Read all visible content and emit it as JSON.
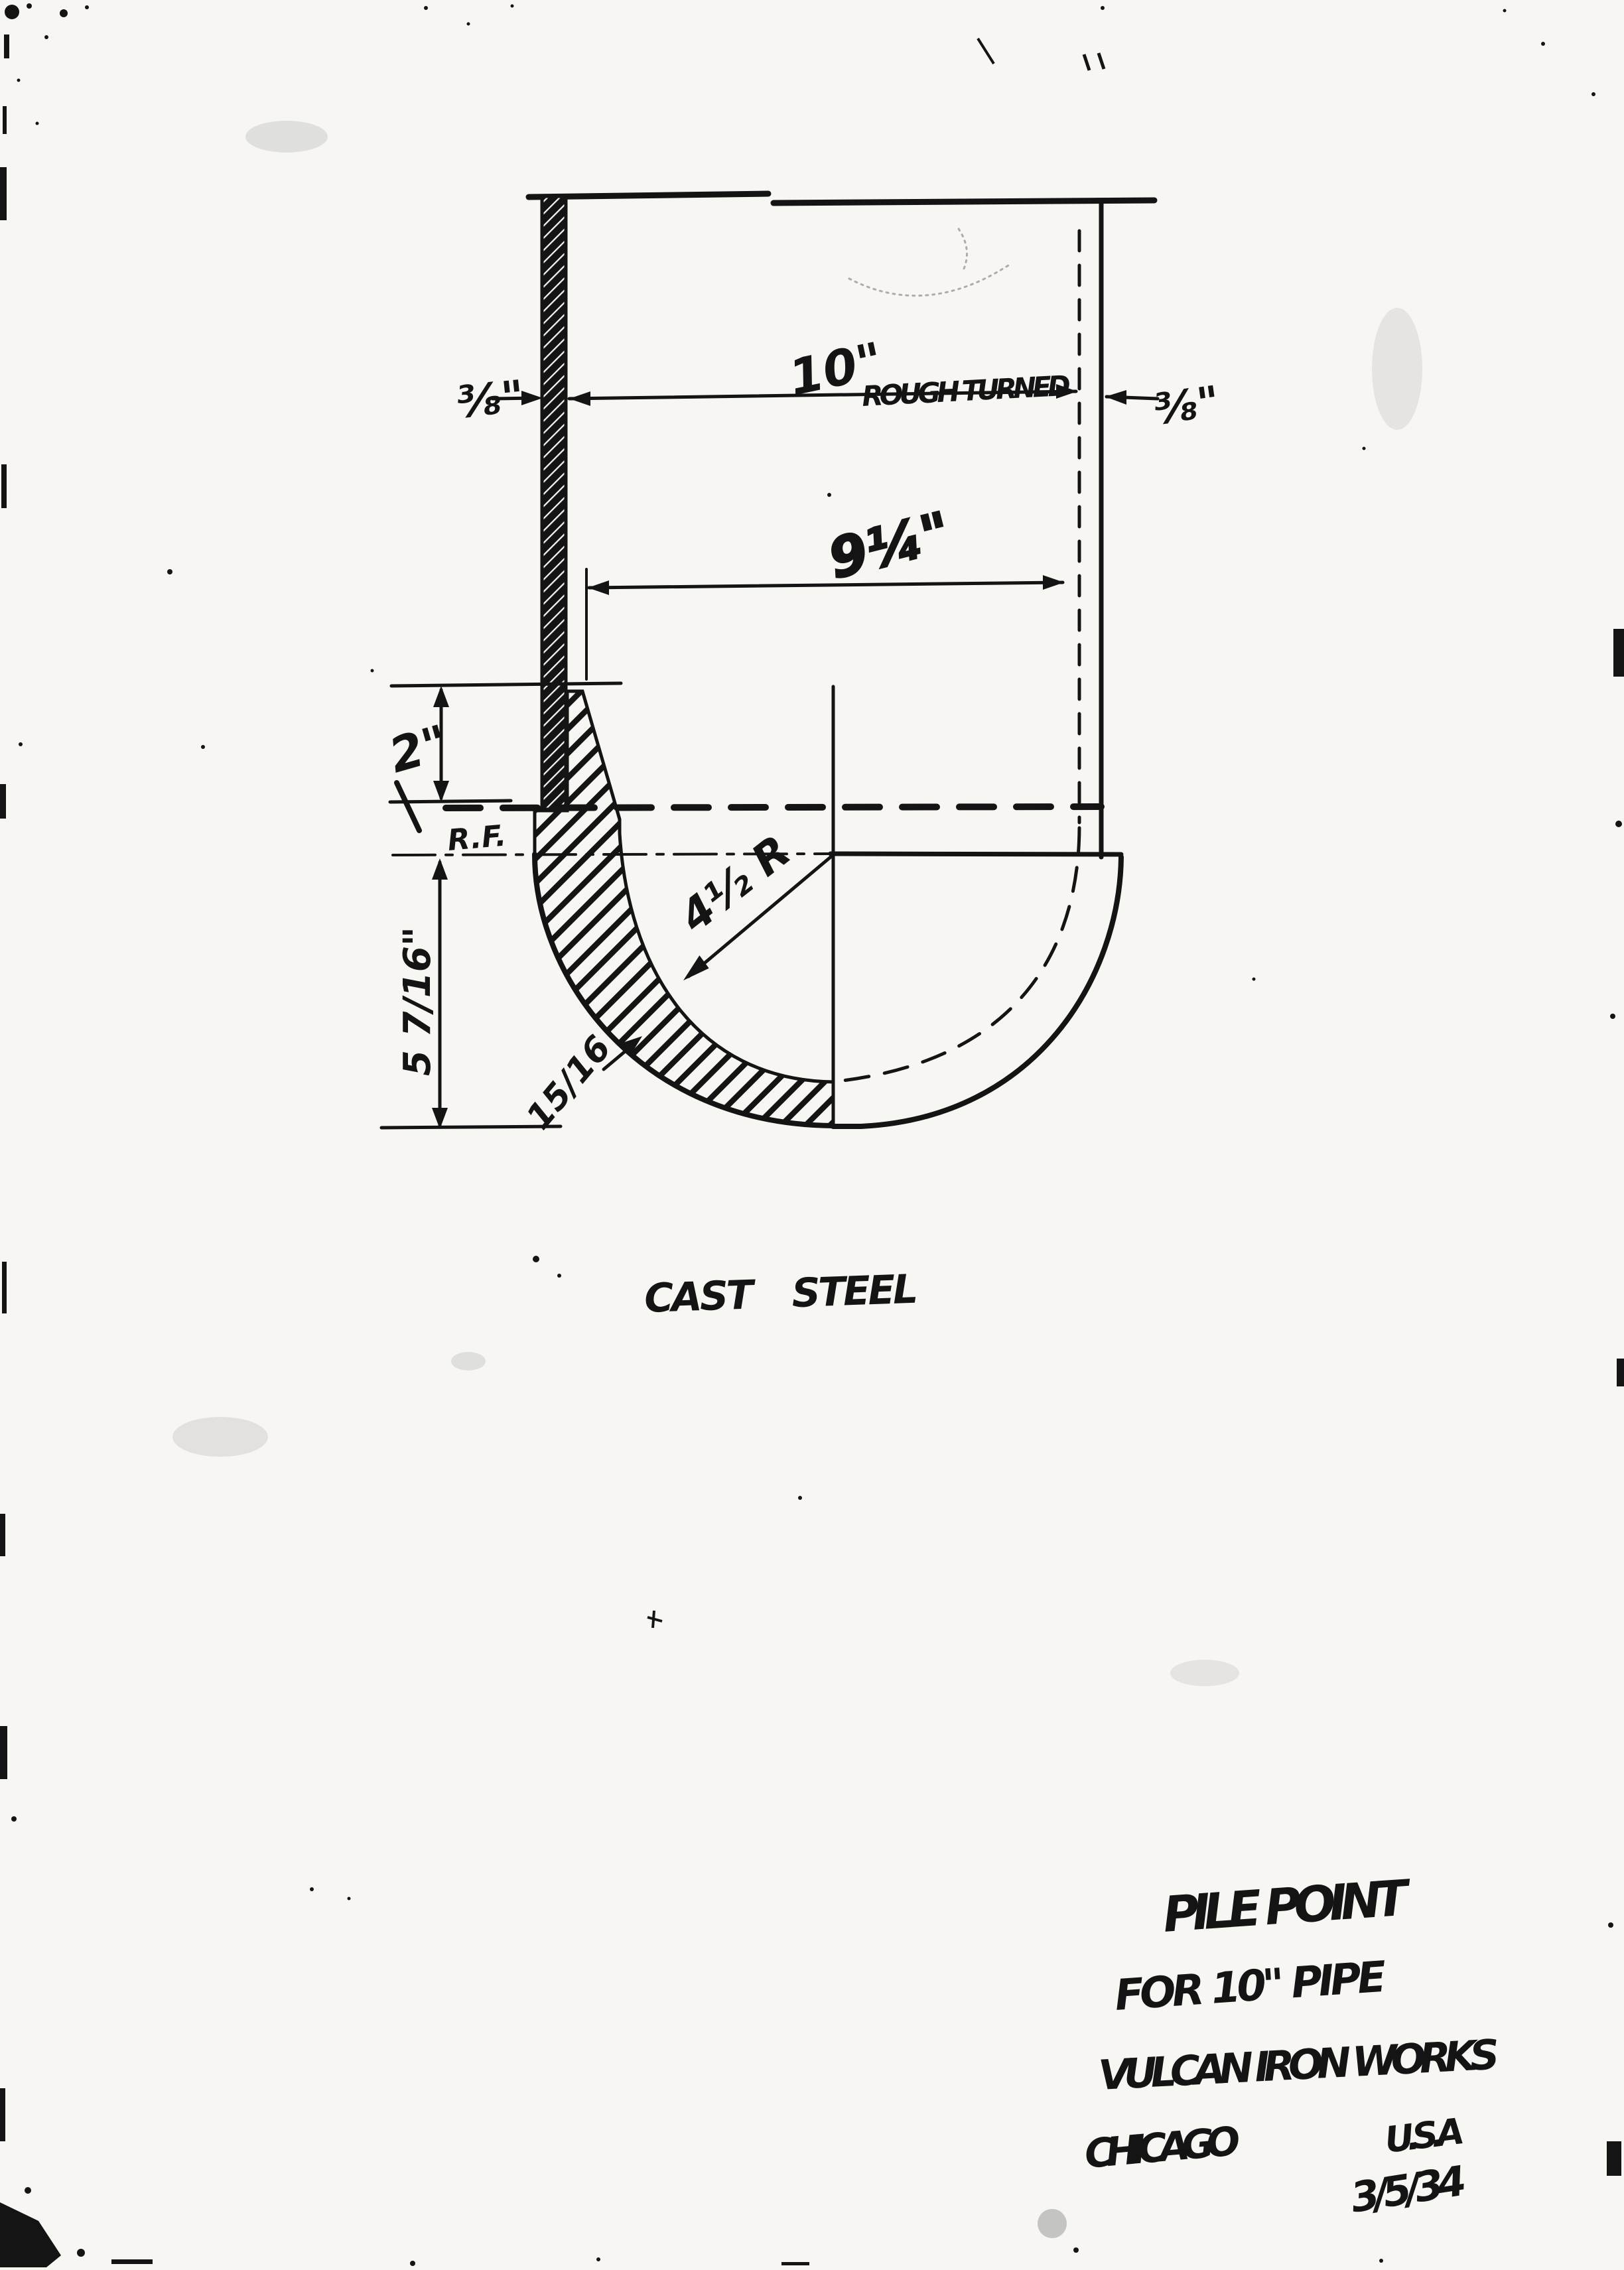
{
  "colors": {
    "paper": "#f7f6f2",
    "ink": "#141414"
  },
  "drawing": {
    "dim_wall_left": "⅜\"",
    "dim_wall_right": "⅜\"",
    "dim_outer_diameter": "10\"",
    "dim_outer_note": "ROUGH TURNED",
    "dim_inner_diameter": "9¼\"",
    "dim_socket_depth": "2\"",
    "seat_label": "R.F.",
    "dim_point_height": "5 7/16\"",
    "dim_inner_radius": "4½ R",
    "dim_shell_thickness": "15/16",
    "material_note": "CAST STEEL"
  },
  "title_block": {
    "product": "PILE POINT",
    "application": "FOR 10\" PIPE",
    "company": "VULCAN IRON WORKS",
    "city": "CHICAGO",
    "country": "U.S.A",
    "date": "3/5/34"
  }
}
